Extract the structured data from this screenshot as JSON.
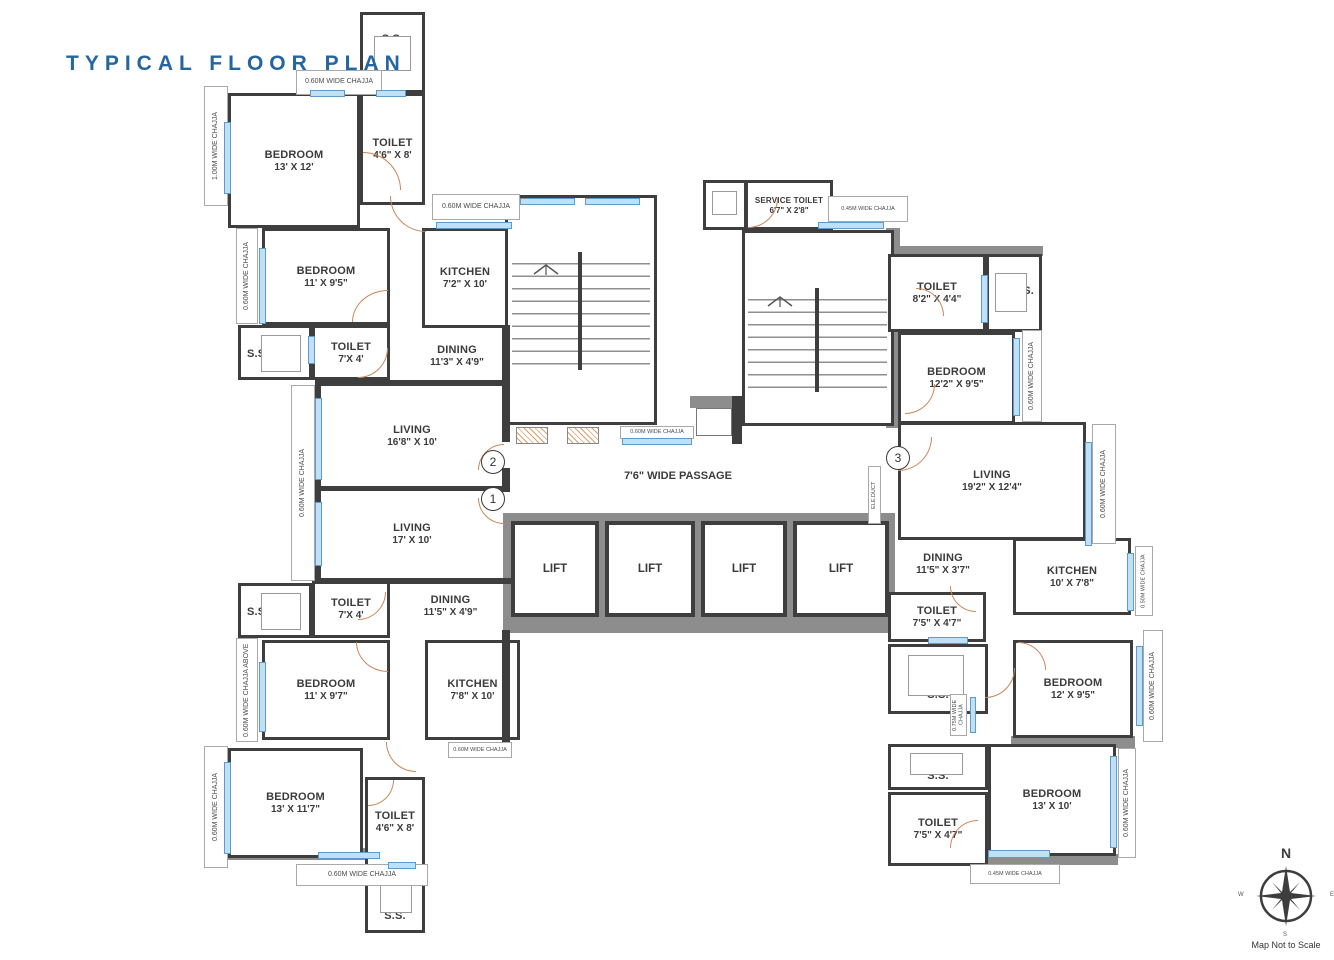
{
  "title": "TYPICAL FLOOR PLAN",
  "labels": {
    "ss": "S.S.",
    "passage": "7'6\" WIDE PASSAGE",
    "duct": "ELE.DUCT"
  },
  "lifts": [
    "LIFT",
    "LIFT",
    "LIFT",
    "LIFT"
  ],
  "markers": {
    "m1": "1",
    "m2": "2",
    "m3": "3"
  },
  "rooms": [
    {
      "name": "BEDROOM",
      "dims": "13' X 12'"
    },
    {
      "name": "TOILET",
      "dims": "4'6\" X 8'"
    },
    {
      "name": "BEDROOM",
      "dims": "11' X 9'5\""
    },
    {
      "name": "TOILET",
      "dims": "7'X 4'"
    },
    {
      "name": "KITCHEN",
      "dims": "7'2\" X 10'"
    },
    {
      "name": "DINING",
      "dims": "11'3\" X 4'9\""
    },
    {
      "name": "LIVING",
      "dims": "16'8\" X 10'"
    },
    {
      "name": "LIVING",
      "dims": "17' X 10'"
    },
    {
      "name": "DINING",
      "dims": "11'5\" X 4'9\""
    },
    {
      "name": "TOILET",
      "dims": "7'X 4'"
    },
    {
      "name": "BEDROOM",
      "dims": "11' X 9'7\""
    },
    {
      "name": "KITCHEN",
      "dims": "7'8\" X 10'"
    },
    {
      "name": "BEDROOM",
      "dims": "13' X 11'7\""
    },
    {
      "name": "TOILET",
      "dims": "4'6\" X 8'"
    },
    {
      "name": "SERVICE TOILET",
      "dims": "6'7\" X 2'8\""
    },
    {
      "name": "TOILET",
      "dims": "8'2\" X 4'4\""
    },
    {
      "name": "BEDROOM",
      "dims": "12'2\" X 9'5\""
    },
    {
      "name": "LIVING",
      "dims": "19'2\" X 12'4\""
    },
    {
      "name": "DINING",
      "dims": "11'5\" X 3'7\""
    },
    {
      "name": "KITCHEN",
      "dims": "10' X 7'8\""
    },
    {
      "name": "TOILET",
      "dims": "7'5\" X 4'7\""
    },
    {
      "name": "BEDROOM",
      "dims": "12' X 9'5\""
    },
    {
      "name": "TOILET",
      "dims": "7'5\" X 4'7\""
    },
    {
      "name": "BEDROOM",
      "dims": "13' X 10'"
    }
  ],
  "chajjas": [
    "0.60M WIDE CHAJJA",
    "1.00M WIDE CHAJJA",
    "0.60M WIDE CHAJJA",
    "0.60M WIDE CHAJJA",
    "0.60M WIDE CHAJJA",
    "0.60M WIDE CHAJJA ABOVE",
    "0.60M WIDE CHAJJA",
    "0.60M WIDE CHAJJA",
    "0.60M WIDE CHAJJA",
    "0.45M WIDE CHAJJA",
    "0.60M WIDE CHAJJA",
    "0.60M WIDE CHAJJA",
    "0.60M WIDE CHAJJA",
    "0.50M WIDE CHAJJA",
    "0.75M WIDE CHAJJA",
    "0.60M WIDE CHAJJA",
    "0.60M WIDE CHAJJA",
    "0.45M WIDE CHAJJA"
  ],
  "compass": {
    "n": "N",
    "e": "E",
    "s": "S",
    "w": "W",
    "note": "Map Not to Scale"
  }
}
